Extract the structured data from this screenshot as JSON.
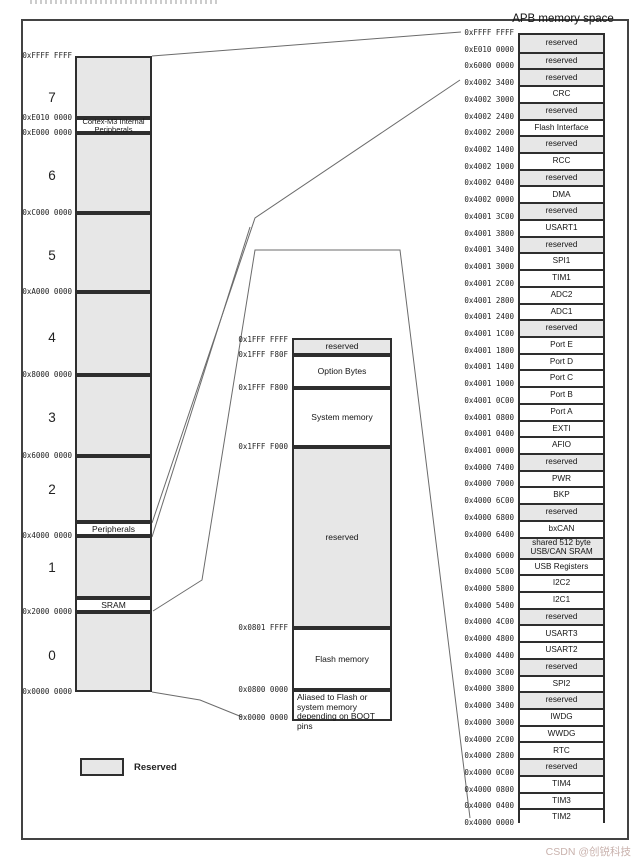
{
  "apb_title": "APB memory space",
  "legend": {
    "label": "Reserved"
  },
  "watermark": "CSDN @创锐科技",
  "colors": {
    "reserved_fill": "#e7e7e7",
    "box_border": "#2e2e2e",
    "connector_line": "#6b6b6b",
    "page_border": "#434343",
    "watermark": "#c9b2ad"
  },
  "left_column": {
    "geometry": {
      "x": 75,
      "w": 77,
      "addr_right": 72
    },
    "segments": [
      {
        "label": "",
        "type": "reserved",
        "y": 56,
        "h": 62
      },
      {
        "label": "Cortex-M3 Internal Peripherals",
        "type": "white",
        "tiny": true,
        "y": 118,
        "h": 15
      },
      {
        "label": "",
        "type": "reserved",
        "y": 133,
        "h": 80
      },
      {
        "label": "",
        "type": "reserved",
        "y": 213,
        "h": 79
      },
      {
        "label": "",
        "type": "reserved",
        "y": 292,
        "h": 83
      },
      {
        "label": "",
        "type": "reserved",
        "y": 375,
        "h": 81
      },
      {
        "label": "",
        "type": "reserved",
        "y": 456,
        "h": 66
      },
      {
        "label": "Peripherals",
        "type": "white",
        "y": 522,
        "h": 14
      },
      {
        "label": "",
        "type": "reserved",
        "y": 536,
        "h": 62
      },
      {
        "label": "SRAM",
        "type": "white",
        "y": 598,
        "h": 14
      },
      {
        "label": "",
        "type": "reserved",
        "y": 612,
        "h": 80
      }
    ],
    "region_numbers": [
      {
        "n": "7",
        "y": 90
      },
      {
        "n": "6",
        "y": 168
      },
      {
        "n": "5",
        "y": 248
      },
      {
        "n": "4",
        "y": 330
      },
      {
        "n": "3",
        "y": 410
      },
      {
        "n": "2",
        "y": 482
      },
      {
        "n": "1",
        "y": 560
      },
      {
        "n": "0",
        "y": 648
      }
    ],
    "addresses": [
      {
        "text": "0xFFFF FFFF",
        "y": 56
      },
      {
        "text": "0xE010 0000",
        "y": 118
      },
      {
        "text": "0xE000 0000",
        "y": 133
      },
      {
        "text": "0xC000 0000",
        "y": 213
      },
      {
        "text": "0xA000 0000",
        "y": 292
      },
      {
        "text": "0x8000 0000",
        "y": 375
      },
      {
        "text": "0x6000 0000",
        "y": 456
      },
      {
        "text": "0x4000 0000",
        "y": 536
      },
      {
        "text": "0x2000 0000",
        "y": 612
      },
      {
        "text": "0x0000 0000",
        "y": 692
      }
    ]
  },
  "middle_column": {
    "geometry": {
      "x": 292,
      "w": 100,
      "addr_right": 288
    },
    "segments": [
      {
        "label": "reserved",
        "type": "reserved",
        "y": 338,
        "h": 17
      },
      {
        "label": "Option Bytes",
        "type": "white",
        "y": 355,
        "h": 33
      },
      {
        "label": "System memory",
        "type": "white",
        "y": 388,
        "h": 59
      },
      {
        "label": "reserved",
        "type": "reserved",
        "y": 447,
        "h": 181
      },
      {
        "label": "Flash memory",
        "type": "white",
        "y": 628,
        "h": 62
      },
      {
        "label": "Aliased to Flash or system memory depending on BOOT pins",
        "type": "white",
        "leftalign": true,
        "y": 690,
        "h": 31
      }
    ],
    "addresses": [
      {
        "text": "0x1FFF FFFF",
        "y": 340
      },
      {
        "text": "0x1FFF F80F",
        "y": 355
      },
      {
        "text": "0x1FFF F800",
        "y": 388
      },
      {
        "text": "0x1FFF F000",
        "y": 447
      },
      {
        "text": "0x0801 FFFF",
        "y": 628
      },
      {
        "text": "0x0800 0000",
        "y": 690
      },
      {
        "text": "0x0000 0000",
        "y": 718
      }
    ]
  },
  "right_column": {
    "geometry": {
      "top": 33,
      "left": 518,
      "width": 87,
      "bottom": 823,
      "row_h": 16.72,
      "tall_row_index": 30,
      "tall_row_h": 21,
      "addr_right": 514
    },
    "rows": [
      {
        "label": "reserved",
        "reserved": true
      },
      {
        "label": "reserved",
        "reserved": true
      },
      {
        "label": "reserved",
        "reserved": true
      },
      {
        "label": "CRC",
        "reserved": false
      },
      {
        "label": "reserved",
        "reserved": true
      },
      {
        "label": "Flash Interface",
        "reserved": false
      },
      {
        "label": "reserved",
        "reserved": true
      },
      {
        "label": "RCC",
        "reserved": false
      },
      {
        "label": "reserved",
        "reserved": true
      },
      {
        "label": "DMA",
        "reserved": false
      },
      {
        "label": "reserved",
        "reserved": true
      },
      {
        "label": "USART1",
        "reserved": false
      },
      {
        "label": "reserved",
        "reserved": true
      },
      {
        "label": "SPI1",
        "reserved": false
      },
      {
        "label": "TIM1",
        "reserved": false
      },
      {
        "label": "ADC2",
        "reserved": false
      },
      {
        "label": "ADC1",
        "reserved": false
      },
      {
        "label": "reserved",
        "reserved": true
      },
      {
        "label": "Port E",
        "reserved": false
      },
      {
        "label": "Port D",
        "reserved": false
      },
      {
        "label": "Port C",
        "reserved": false
      },
      {
        "label": "Port B",
        "reserved": false
      },
      {
        "label": "Port A",
        "reserved": false
      },
      {
        "label": "EXTI",
        "reserved": false
      },
      {
        "label": "AFIO",
        "reserved": false
      },
      {
        "label": "reserved",
        "reserved": true
      },
      {
        "label": "PWR",
        "reserved": false
      },
      {
        "label": "BKP",
        "reserved": false
      },
      {
        "label": "reserved",
        "reserved": true
      },
      {
        "label": "bxCAN",
        "reserved": false
      },
      {
        "label": "shared 512 byte USB/CAN SRAM",
        "reserved": true
      },
      {
        "label": "USB Registers",
        "reserved": false
      },
      {
        "label": "I2C2",
        "reserved": false
      },
      {
        "label": "I2C1",
        "reserved": false
      },
      {
        "label": "reserved",
        "reserved": true
      },
      {
        "label": "USART3",
        "reserved": false
      },
      {
        "label": "USART2",
        "reserved": false
      },
      {
        "label": "reserved",
        "reserved": true
      },
      {
        "label": "SPI2",
        "reserved": false
      },
      {
        "label": "reserved",
        "reserved": true
      },
      {
        "label": "IWDG",
        "reserved": false
      },
      {
        "label": "WWDG",
        "reserved": false
      },
      {
        "label": "RTC",
        "reserved": false
      },
      {
        "label": "reserved",
        "reserved": true
      },
      {
        "label": "TIM4",
        "reserved": false
      },
      {
        "label": "TIM3",
        "reserved": false
      },
      {
        "label": "TIM2",
        "reserved": false
      }
    ],
    "addresses": [
      "0xFFFF FFFF",
      "0xE010 0000",
      "0x6000 0000",
      "0x4002 3400",
      "0x4002 3000",
      "0x4002 2400",
      "0x4002 2000",
      "0x4002 1400",
      "0x4002 1000",
      "0x4002 0400",
      "0x4002 0000",
      "0x4001 3C00",
      "0x4001 3800",
      "0x4001 3400",
      "0x4001 3000",
      "0x4001 2C00",
      "0x4001 2800",
      "0x4001 2400",
      "0x4001 1C00",
      "0x4001 1800",
      "0x4001 1400",
      "0x4001 1000",
      "0x4001 0C00",
      "0x4001 0800",
      "0x4001 0400",
      "0x4001 0000",
      "0x4000 7400",
      "0x4000 7000",
      "0x4000 6C00",
      "0x4000 6800",
      "0x4000 6400",
      "0x4000 6000",
      "0x4000 5C00",
      "0x4000 5800",
      "0x4000 5400",
      "0x4000 4C00",
      "0x4000 4800",
      "0x4000 4400",
      "0x4000 3C00",
      "0x4000 3800",
      "0x4000 3400",
      "0x4000 3000",
      "0x4000 2C00",
      "0x4000 2800",
      "0x4000 0C00",
      "0x4000 0800",
      "0x4000 0400",
      "0x4000 0000"
    ]
  },
  "connector_lines": [
    [
      [
        152,
        56
      ],
      [
        461,
        32
      ]
    ],
    [
      [
        152,
        523
      ],
      [
        255,
        218
      ],
      [
        460,
        80
      ]
    ],
    [
      [
        152,
        537
      ],
      [
        250,
        227
      ]
    ],
    [
      [
        153,
        611
      ],
      [
        202,
        580
      ],
      [
        255,
        250
      ],
      [
        400,
        250
      ],
      [
        470,
        818
      ]
    ],
    [
      [
        152,
        692
      ],
      [
        200,
        700
      ],
      [
        242,
        717
      ]
    ]
  ]
}
